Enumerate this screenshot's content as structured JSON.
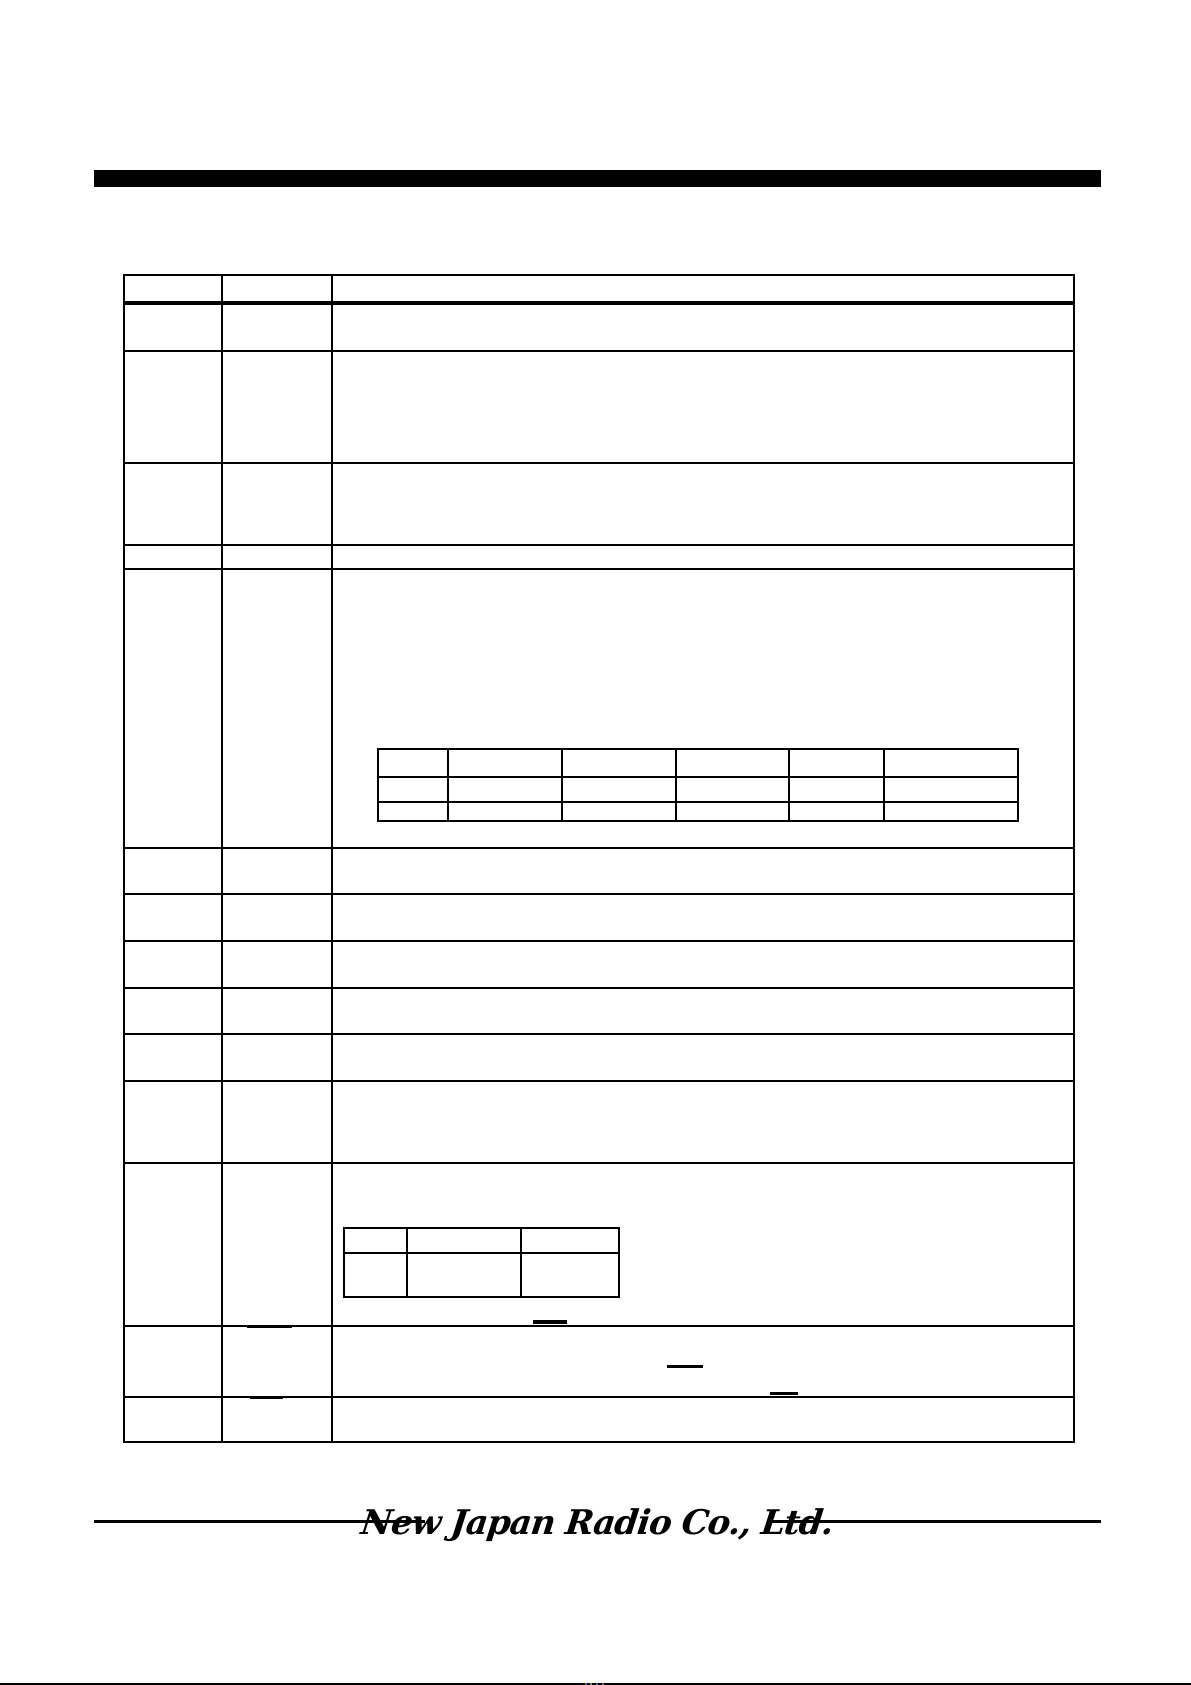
{
  "page": {
    "width": 1191,
    "height": 1685,
    "background": "#ffffff"
  },
  "title_bar": {
    "x": 94,
    "y": 170,
    "width": 1007,
    "height": 17,
    "color": "#000000",
    "label": ""
  },
  "main_table": {
    "x": 123,
    "y": 274,
    "width": 952,
    "height": 1169,
    "border_color": "#000000",
    "column_divider_xs": [
      96,
      206
    ],
    "header_bold_line": {
      "y": 25,
      "thickness": 4
    },
    "row_line_ys": [
      74,
      186,
      268,
      292,
      571,
      617,
      664,
      711,
      757,
      804,
      886,
      1049,
      1120
    ],
    "columns": 3,
    "rows": 15,
    "cell_text": ""
  },
  "inner_tables": [
    {
      "name": "inner-table-1",
      "x": 377,
      "y": 748,
      "width": 642,
      "height": 74,
      "row_line_ys": [
        26,
        51
      ],
      "column_divider_xs": [
        68,
        182,
        296,
        409,
        504
      ],
      "rows": 3,
      "columns": 6,
      "cell_text": ""
    },
    {
      "name": "inner-table-2",
      "x": 343,
      "y": 1227,
      "width": 277,
      "height": 71,
      "row_line_ys": [
        23
      ],
      "column_divider_xs": [
        61,
        175
      ],
      "rows": 2,
      "columns": 3,
      "cell_text": ""
    }
  ],
  "overline_marks": [
    {
      "x": 247,
      "y": 1325,
      "width": 45,
      "height": 2.5
    },
    {
      "x": 533,
      "y": 1320,
      "width": 34,
      "height": 3.5
    },
    {
      "x": 667,
      "y": 1365,
      "width": 36,
      "height": 2.5
    },
    {
      "x": 770,
      "y": 1392,
      "width": 28,
      "height": 3
    },
    {
      "x": 250,
      "y": 1396,
      "width": 33,
      "height": 2.5
    }
  ],
  "footer": {
    "logo_text": "New Japan Radio Co., Ltd.",
    "rule_color": "#000000",
    "rules": [
      {
        "x": 94,
        "y": 1520,
        "width": 331,
        "height": 2.5
      },
      {
        "x": 770,
        "y": 1520,
        "width": 331,
        "height": 2.5
      }
    ],
    "logo_center_x": 597,
    "logo_center_y": 1523
  },
  "bottom_edge": {
    "line": {
      "x": 0,
      "y": 1683,
      "width": 1191,
      "height": 2,
      "color": "#000000"
    },
    "specks": [
      {
        "x": 585,
        "y": 1683,
        "color": "#4466cc"
      },
      {
        "x": 590,
        "y": 1683,
        "color": "#44aa55"
      },
      {
        "x": 596,
        "y": 1683,
        "color": "#3366bb"
      },
      {
        "x": 602,
        "y": 1683,
        "color": "#bb4466"
      }
    ]
  }
}
